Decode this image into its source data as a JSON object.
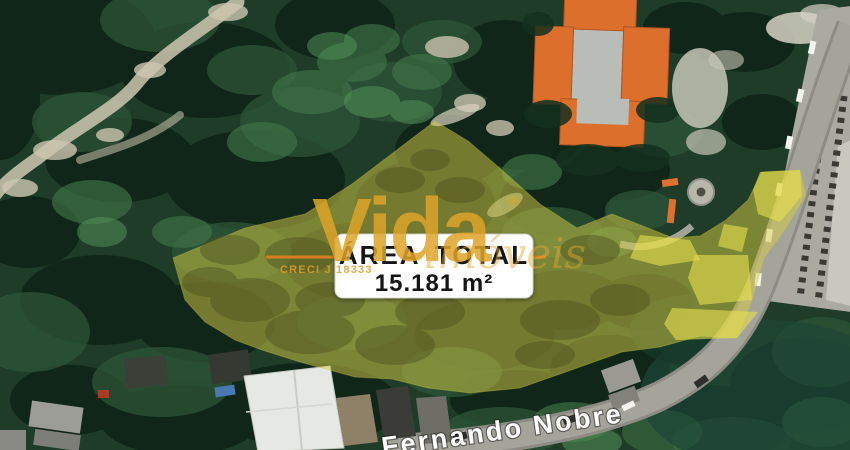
{
  "map": {
    "area_label": {
      "title": "ÁREA TOTAL",
      "value": "15.181 m²"
    },
    "street_label": {
      "name": "Fernando Nobre"
    },
    "watermark": {
      "brand": "Vida",
      "registered_mark": "®",
      "tagline": "imóveis",
      "creci": "CRECI J 18333"
    },
    "colors": {
      "highlight_overlay": "#D8CE45",
      "highlight_bright": "#E8E14E",
      "brand_gold": "#DFA428",
      "flourish_orange": "#E0821E",
      "roof_orange": "#DD6F2D",
      "label_text": "#151515",
      "street_text": "#FFFFFF"
    }
  }
}
